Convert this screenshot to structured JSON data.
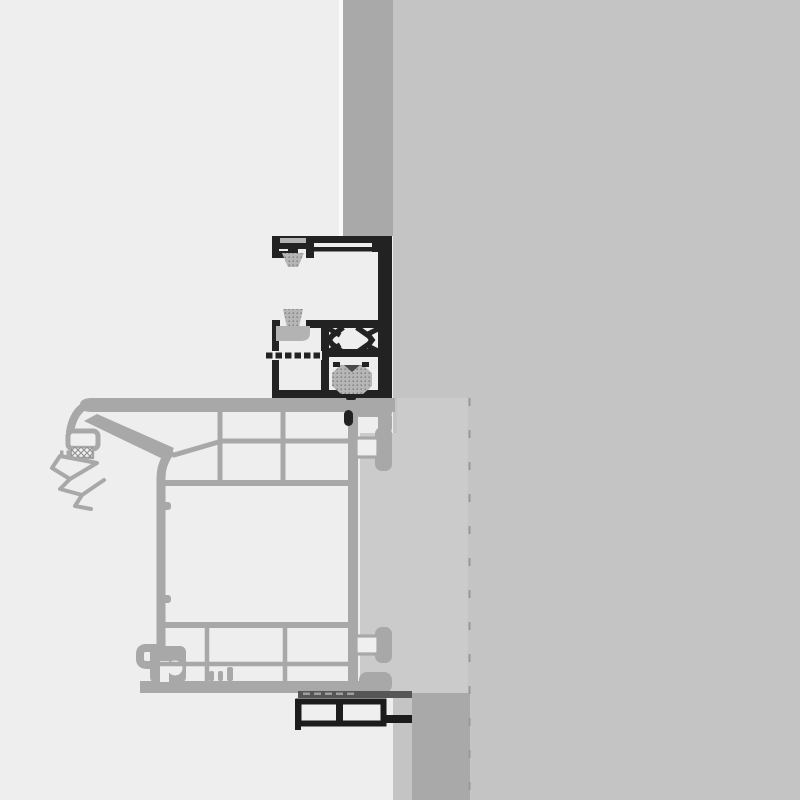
{
  "drawing": {
    "kind": "technical-section-detail",
    "subject": "window-frame-with-roller-shutter-guide-rail-at-wall-reveal"
  },
  "colors": {
    "background": "#eeeeee",
    "wall": "#c4c4c4",
    "wall_edge_strip": "#a9a9a9",
    "reveal_infill": "#cbcbcb",
    "wall_band_below": "#a9a9a9",
    "frame_profile": "#a8a8a8",
    "chamber_fill": "#efefef",
    "guide_rail": "#222222",
    "seal_soft": "#b6b6b6",
    "seal_holder": "#b3b3b3",
    "seal_dark": "#565656",
    "seal_notch": "#4a4a4a",
    "boundary_dash": "#999999"
  }
}
